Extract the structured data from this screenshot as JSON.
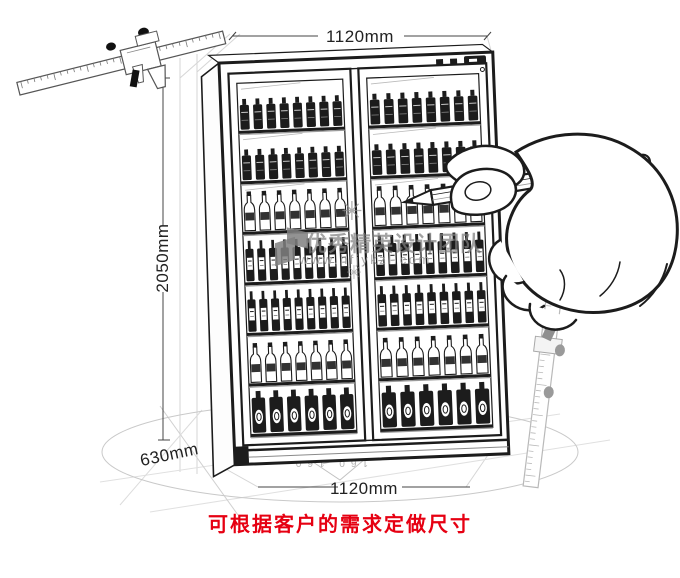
{
  "dimensions": {
    "top_width": "1120mm",
    "height": "2050mm",
    "depth": "630mm",
    "bottom_width": "1120mm"
  },
  "note": {
    "text": "可根据客户的需求定做尺寸"
  },
  "watermark": {
    "team": "优秀精英设计团队",
    "url": "www.hfjykzl.com",
    "flake": "✳"
  },
  "floor_marks": "160  160",
  "cabinet": {
    "door_count": 2,
    "shelves_per_door": 7,
    "shelf_rows": [
      {
        "type": "cans",
        "count": 8
      },
      {
        "type": "cans",
        "count": 8
      },
      {
        "type": "bottles",
        "count": 7
      },
      {
        "type": "tall-bottles",
        "count": 9
      },
      {
        "type": "tall-bottles",
        "count": 9
      },
      {
        "type": "bottles",
        "count": 7
      },
      {
        "type": "big-bottles",
        "count": 6
      }
    ],
    "control_panel": {
      "buttons": 2,
      "display": 1
    }
  },
  "colors": {
    "ink": "#1c1c1c",
    "faint": "#cccccc",
    "ruler_gray": "#b9b9b9",
    "red": "#e60012"
  }
}
